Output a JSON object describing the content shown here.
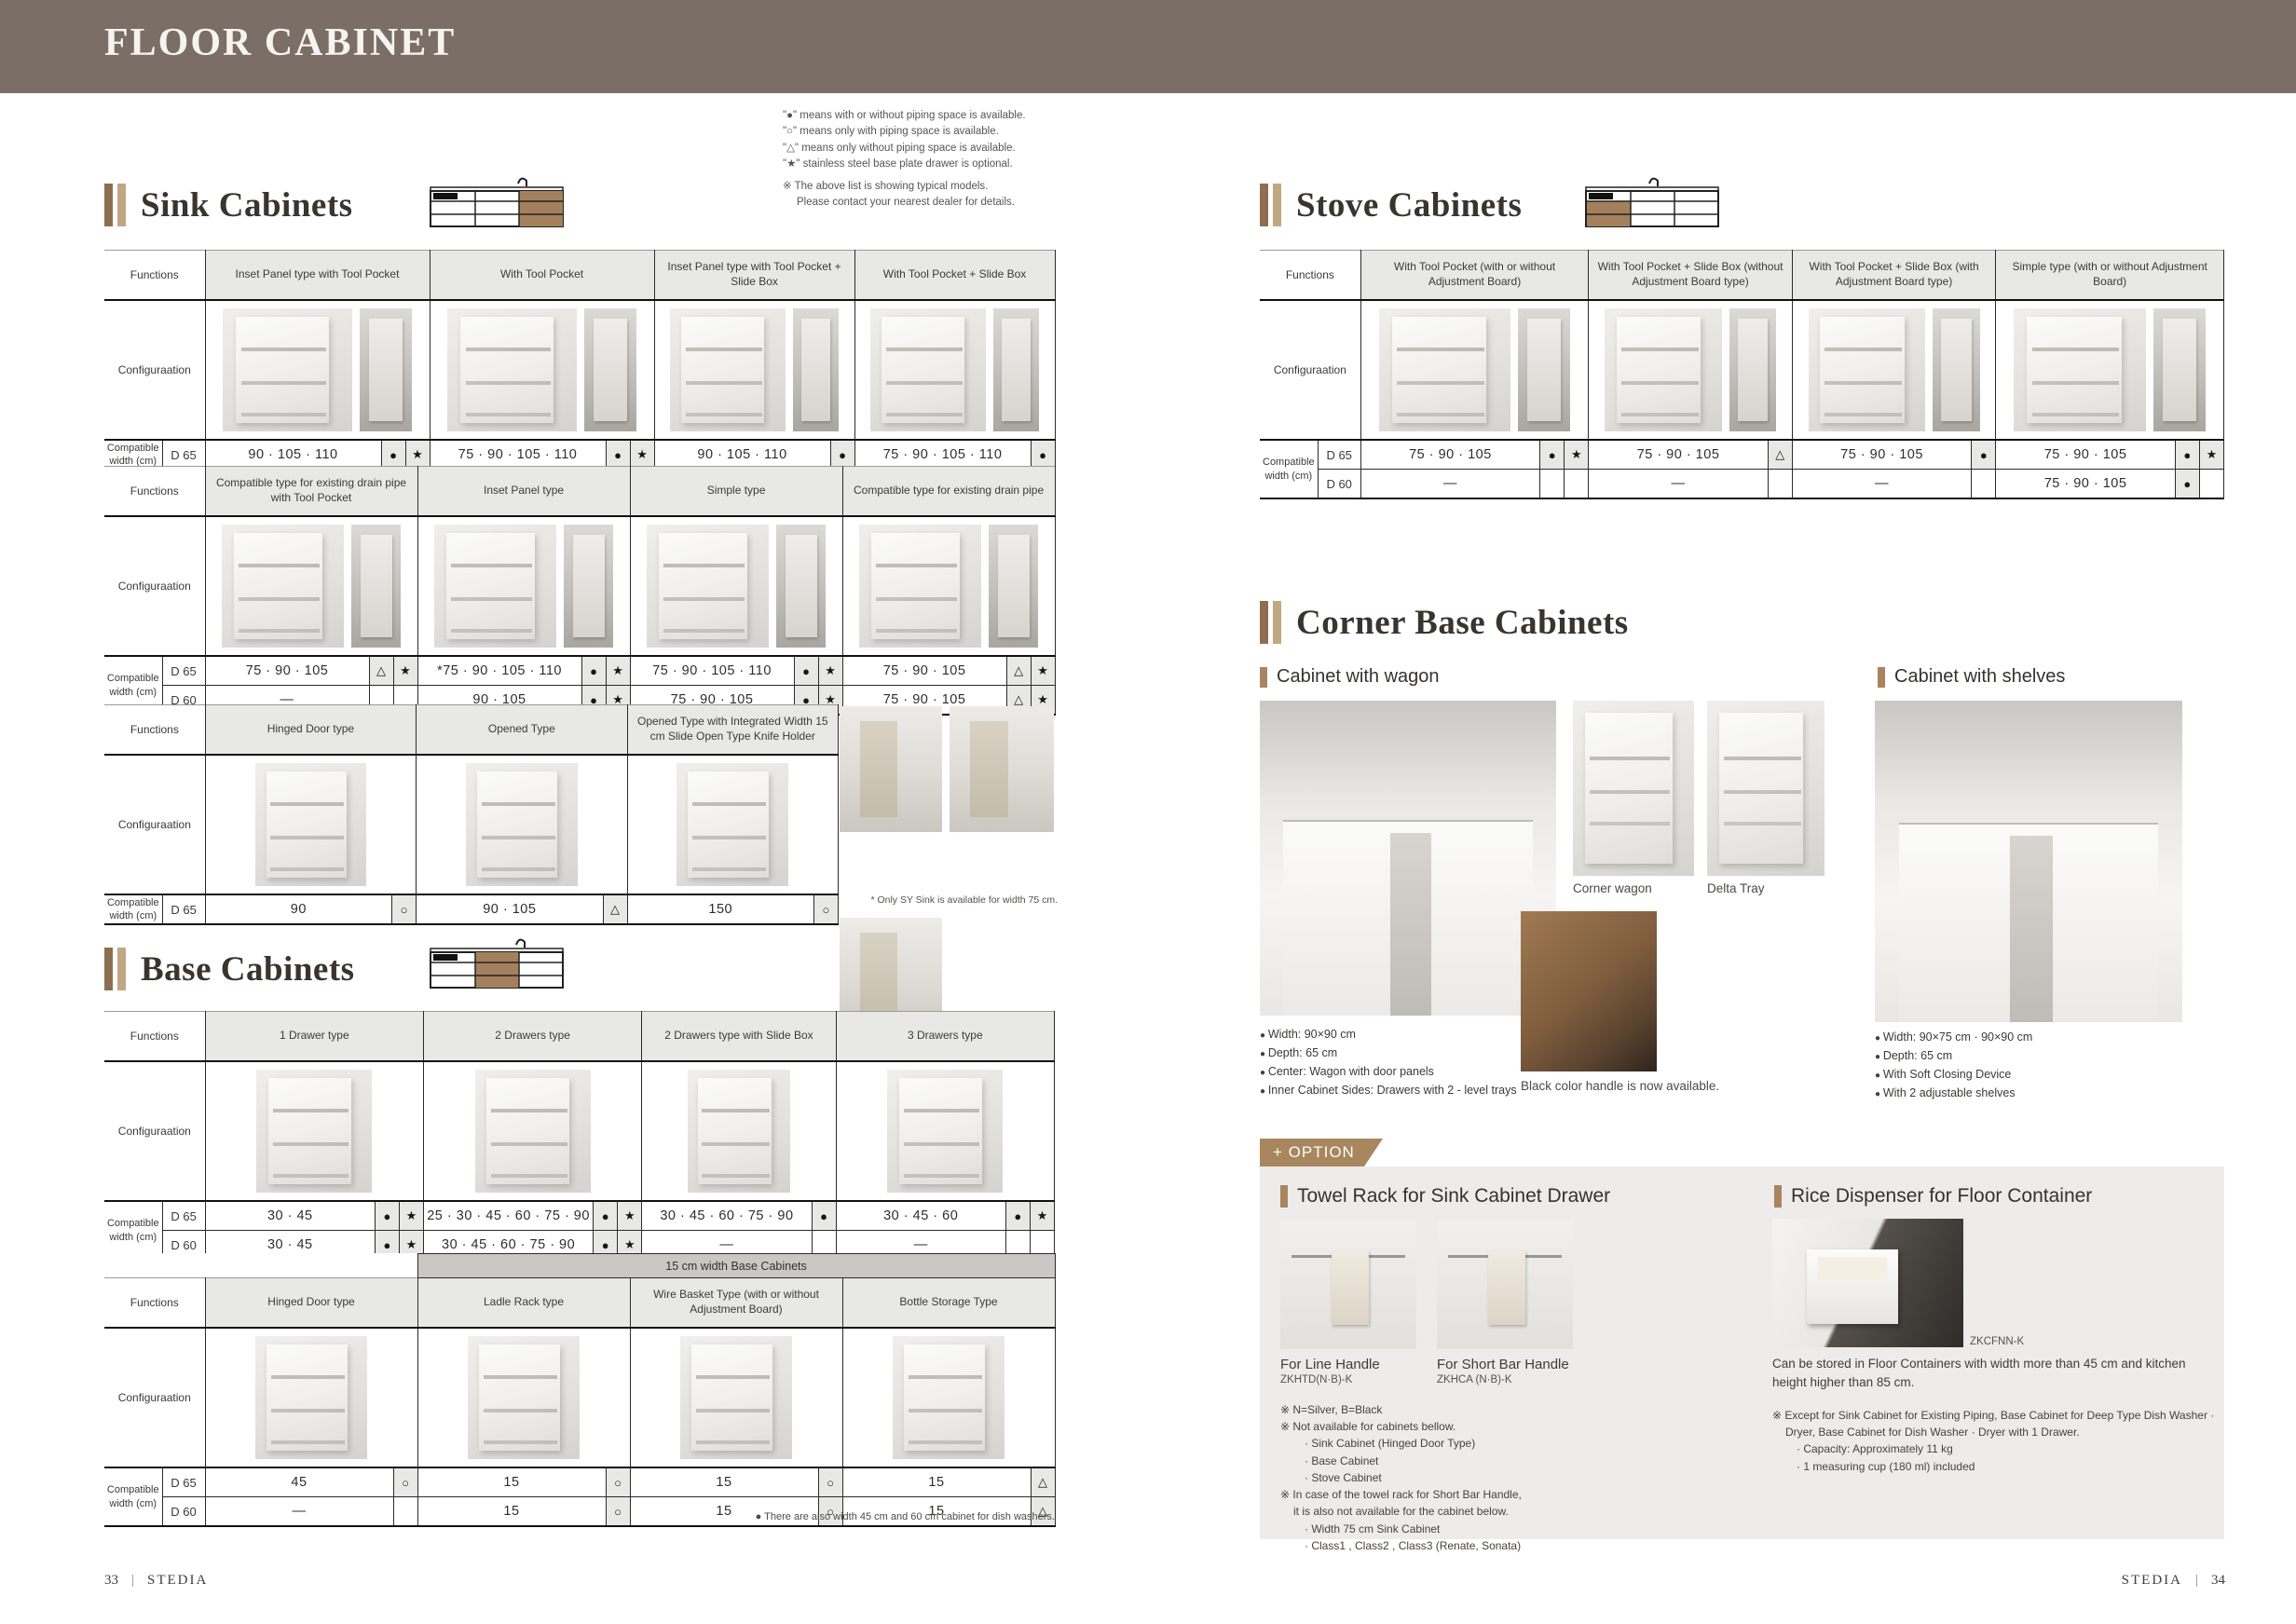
{
  "page": {
    "title": "FLOOR CABINET",
    "footer_left_page": "33",
    "footer_left_brand": "STEDIA",
    "footer_right_brand": "STEDIA",
    "footer_right_page": "34"
  },
  "legend": {
    "lines": [
      "\"●\" means with or without piping space is available.",
      "\"○\" means only with piping space is available.",
      "\"△\" means only without piping space is available.",
      "\"★\" stainless steel base plate drawer is optional."
    ],
    "note1": "※ The above list is showing typical models.",
    "note2": "Please contact your nearest dealer for details."
  },
  "labels": {
    "functions": "Functions",
    "configuration": "Configuraation",
    "compatible_width": "Compatible width (cm)",
    "d65": "D 65",
    "d60": "D 60"
  },
  "sink": {
    "title": "Sink Cabinets",
    "note": "* Only SY Sink is available for width 75 cm.",
    "tables": [
      {
        "row_labels": [
          "D 65"
        ],
        "photo": "duo",
        "columns": [
          {
            "header": "Inset Panel type with Tool Pocket",
            "rows": [
              {
                "v": "90 · 105 · 110",
                "m": [
                  "●",
                  "★"
                ]
              }
            ]
          },
          {
            "header": "With Tool Pocket",
            "rows": [
              {
                "v": "75 · 90 · 105 · 110",
                "m": [
                  "●",
                  "★"
                ]
              }
            ]
          },
          {
            "header": "Inset Panel type with Tool Pocket + Slide Box",
            "rows": [
              {
                "v": "90 · 105 · 110",
                "m": [
                  "●"
                ]
              }
            ]
          },
          {
            "header": "With Tool Pocket + Slide Box",
            "rows": [
              {
                "v": "75 · 90 · 105 · 110",
                "m": [
                  "●"
                ]
              }
            ]
          }
        ]
      },
      {
        "row_labels": [
          "D 65",
          "D 60"
        ],
        "photo": "duo",
        "columns": [
          {
            "header": "Compatible type for existing drain pipe with Tool Pocket",
            "rows": [
              {
                "v": "75 · 90 · 105",
                "m": [
                  "△",
                  "★"
                ]
              },
              {
                "v": "—",
                "m": [
                  "",
                  ""
                ]
              }
            ]
          },
          {
            "header": "Inset Panel type",
            "rows": [
              {
                "v": "*75 · 90 · 105 · 110",
                "m": [
                  "●",
                  "★"
                ]
              },
              {
                "v": "90 · 105",
                "m": [
                  "●",
                  "★"
                ]
              }
            ]
          },
          {
            "header": "Simple type",
            "rows": [
              {
                "v": "75 · 90 · 105 · 110",
                "m": [
                  "●",
                  "★"
                ]
              },
              {
                "v": "75 · 90 · 105",
                "m": [
                  "●",
                  "★"
                ]
              }
            ]
          },
          {
            "header": "Compatible type for existing drain pipe",
            "rows": [
              {
                "v": "75 · 90 · 105",
                "m": [
                  "△",
                  "★"
                ]
              },
              {
                "v": "75 · 90 · 105",
                "m": [
                  "△",
                  "★"
                ]
              }
            ]
          }
        ]
      },
      {
        "row_labels": [
          "D 65"
        ],
        "photo": "single",
        "columns": [
          {
            "header": "Hinged Door type",
            "rows": [
              {
                "v": "90",
                "m": [
                  "○"
                ]
              }
            ]
          },
          {
            "header": "Opened Type",
            "rows": [
              {
                "v": "90 · 105",
                "m": [
                  "△"
                ]
              }
            ]
          },
          {
            "header": "Opened Type with Integrated Width 15 cm Slide Open Type Knife Holder",
            "rows": [
              {
                "v": "150",
                "m": [
                  "○"
                ]
              }
            ]
          }
        ]
      }
    ]
  },
  "base": {
    "title": "Base Cabinets",
    "note": "● There are also width 45 cm and 60 cm cabinet for dish washers.",
    "tables": [
      {
        "row_labels": [
          "D 65",
          "D 60"
        ],
        "photo": "single",
        "columns": [
          {
            "header": "1 Drawer type",
            "rows": [
              {
                "v": "30 · 45",
                "m": [
                  "●",
                  "★"
                ]
              },
              {
                "v": "30 · 45",
                "m": [
                  "●",
                  "★"
                ]
              }
            ]
          },
          {
            "header": "2 Drawers type",
            "rows": [
              {
                "v": "25 · 30 · 45 · 60 · 75 · 90",
                "m": [
                  "●",
                  "★"
                ]
              },
              {
                "v": "30 · 45 · 60 · 75 · 90",
                "m": [
                  "●",
                  "★"
                ]
              }
            ]
          },
          {
            "header": "2 Drawers type with Slide Box",
            "rows": [
              {
                "v": "30 · 45 · 60 · 75 · 90",
                "m": [
                  "●"
                ]
              },
              {
                "v": "—",
                "m": [
                  ""
                ]
              }
            ]
          },
          {
            "header": "3 Drawers type",
            "rows": [
              {
                "v": "30 · 45 · 60",
                "m": [
                  "●",
                  "★"
                ]
              },
              {
                "v": "—",
                "m": [
                  "",
                  ""
                ]
              }
            ]
          }
        ]
      },
      {
        "row_labels": [
          "D 65",
          "D 60"
        ],
        "photo": "single",
        "band": {
          "text": "15 cm width Base Cabinets",
          "from": 1
        },
        "columns": [
          {
            "header": "Hinged Door type",
            "rows": [
              {
                "v": "45",
                "m": [
                  "○"
                ]
              },
              {
                "v": "—",
                "m": [
                  ""
                ]
              }
            ]
          },
          {
            "header": "Ladle Rack type",
            "rows": [
              {
                "v": "15",
                "m": [
                  "○"
                ]
              },
              {
                "v": "15",
                "m": [
                  "○"
                ]
              }
            ]
          },
          {
            "header": "Wire Basket Type (with or without Adjustment Board)",
            "rows": [
              {
                "v": "15",
                "m": [
                  "○"
                ]
              },
              {
                "v": "15",
                "m": [
                  "○"
                ]
              }
            ]
          },
          {
            "header": "Bottle Storage Type",
            "rows": [
              {
                "v": "15",
                "m": [
                  "△"
                ]
              },
              {
                "v": "15",
                "m": [
                  "△"
                ]
              }
            ]
          }
        ]
      }
    ]
  },
  "stove": {
    "title": "Stove Cabinets",
    "tables": [
      {
        "row_labels": [
          "D 65",
          "D 60"
        ],
        "photo": "duo",
        "columns": [
          {
            "header": "With Tool Pocket (with or without Adjustment Board)",
            "rows": [
              {
                "v": "75 · 90 · 105",
                "m": [
                  "●",
                  "★"
                ]
              },
              {
                "v": "—",
                "m": [
                  "",
                  ""
                ]
              }
            ]
          },
          {
            "header": "With Tool Pocket + Slide Box (without Adjustment Board type)",
            "rows": [
              {
                "v": "75 · 90 · 105",
                "m": [
                  "△"
                ]
              },
              {
                "v": "—",
                "m": [
                  ""
                ]
              }
            ]
          },
          {
            "header": "With Tool Pocket + Slide Box (with Adjustment Board type)",
            "rows": [
              {
                "v": "75 · 90 · 105",
                "m": [
                  "●"
                ]
              },
              {
                "v": "—",
                "m": [
                  ""
                ]
              }
            ]
          },
          {
            "header": "Simple type (with or without Adjustment Board)",
            "rows": [
              {
                "v": "75 · 90 · 105",
                "m": [
                  "●",
                  "★"
                ]
              },
              {
                "v": "75 · 90 · 105",
                "m": [
                  "●",
                  ""
                ]
              }
            ]
          }
        ]
      }
    ]
  },
  "corner": {
    "title": "Corner Base Cabinets",
    "wagon": {
      "title": "Cabinet with wagon",
      "captions": [
        "Corner wagon",
        "Delta Tray"
      ],
      "bullets": [
        "Width: 90×90 cm",
        "Depth: 65 cm",
        "Center: Wagon with door panels",
        "Inner Cabinet Sides: Drawers with 2 - level trays"
      ],
      "handle_note": "Black color handle is now available."
    },
    "shelves": {
      "title": "Cabinet with shelves",
      "bullets": [
        "Width: 90×75 cm · 90×90 cm",
        "Depth: 65 cm",
        "With Soft Closing Device",
        "With 2 adjustable shelves"
      ]
    }
  },
  "option": {
    "tab": "+ OPTION",
    "towel": {
      "title": "Towel Rack for Sink Cabinet Drawer",
      "items": [
        {
          "caption": "For Line Handle",
          "code": "ZKHTD(N·B)-K"
        },
        {
          "caption": "For Short Bar Handle",
          "code": "ZKHCA (N·B)-K"
        }
      ],
      "notes": [
        "※ N=Silver, B=Black",
        "※ Not available for cabinets bellow.",
        "· Sink Cabinet (Hinged Door Type)",
        "· Base Cabinet",
        "· Stove Cabinet",
        "※ In case of the towel rack for Short Bar Handle,",
        "it is also not available for the cabinet below.",
        "· Width 75 cm Sink Cabinet",
        "· Class1 , Class2 , Class3 (Renate, Sonata)"
      ]
    },
    "rice": {
      "title": "Rice Dispenser for Floor Container",
      "code": "ZKCFNN-K",
      "desc": "Can be stored in Floor Containers with width more than 45 cm and kitchen height higher than 85 cm.",
      "notes": [
        "※ Except for Sink Cabinet for Existing Piping, Base Cabinet for Deep Type Dish Washer · Dryer, Base Cabinet for Dish Washer · Dryer with 1 Drawer.",
        "· Capacity: Approximately 11 kg",
        "· 1 measuring cup (180 ml) included"
      ]
    }
  }
}
